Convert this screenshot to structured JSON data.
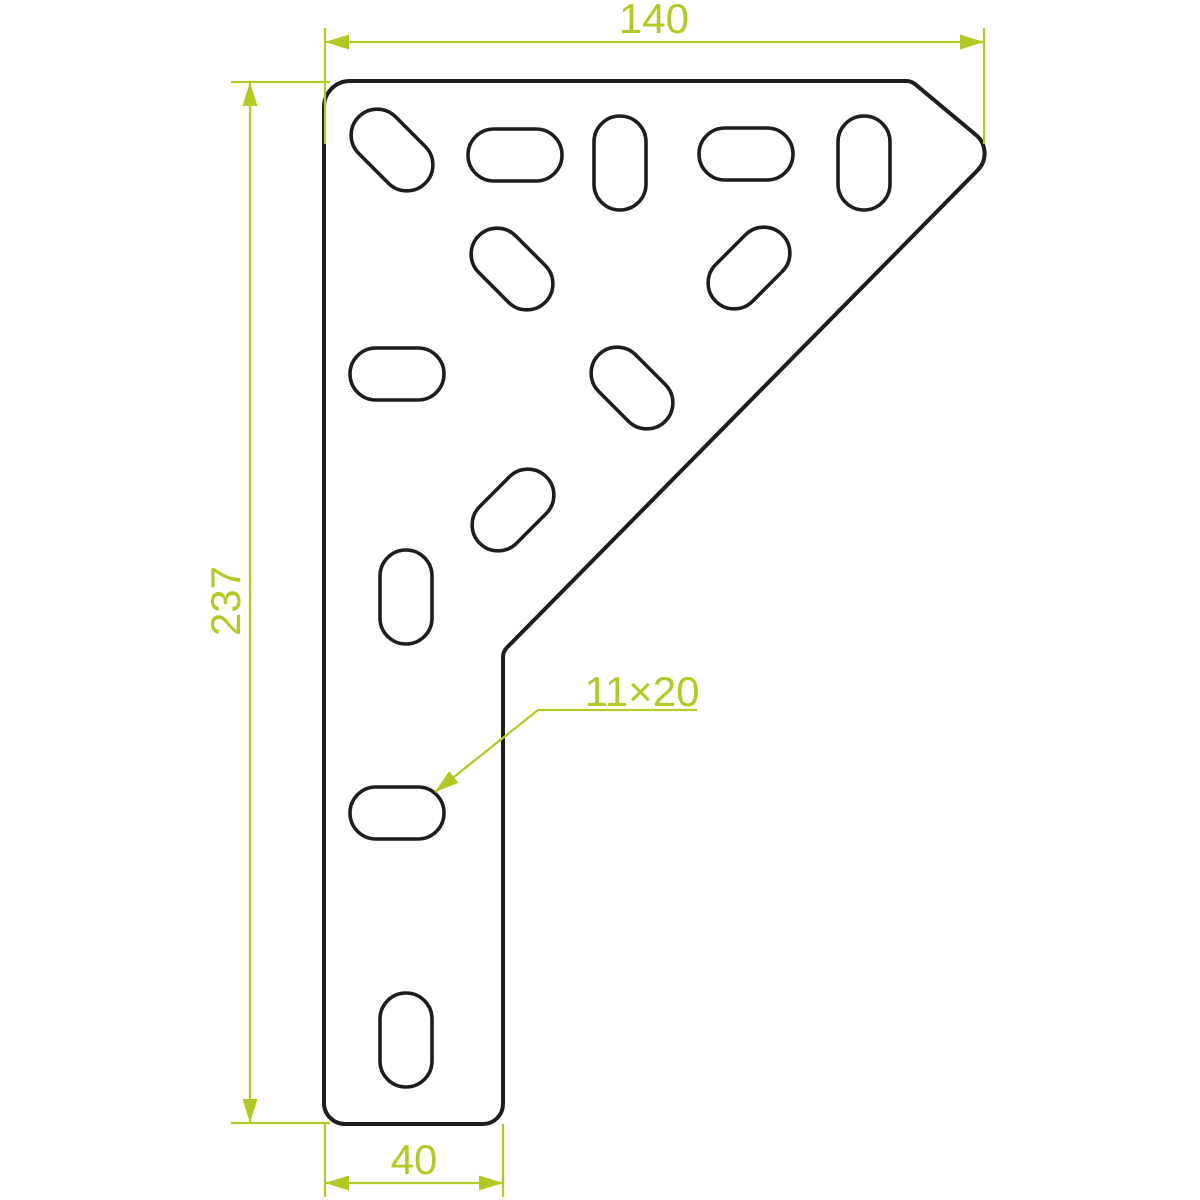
{
  "dimensions": {
    "top_width": "140",
    "left_height": "237",
    "bottom_width": "40",
    "slot_size": "11×20"
  },
  "colors": {
    "background": "#ffffff",
    "outline": "#1d1d1b",
    "dimension": "#b3c824"
  },
  "slots": [
    {
      "cx": 392,
      "cy": 150,
      "orientation": "diagonal-down"
    },
    {
      "cx": 515,
      "cy": 155,
      "orientation": "horizontal"
    },
    {
      "cx": 620,
      "cy": 163,
      "orientation": "vertical"
    },
    {
      "cx": 746,
      "cy": 154,
      "orientation": "horizontal"
    },
    {
      "cx": 864,
      "cy": 163,
      "orientation": "vertical"
    },
    {
      "cx": 512,
      "cy": 269,
      "orientation": "diagonal-down"
    },
    {
      "cx": 749,
      "cy": 268,
      "orientation": "diagonal-up"
    },
    {
      "cx": 397,
      "cy": 374,
      "orientation": "horizontal"
    },
    {
      "cx": 632,
      "cy": 388,
      "orientation": "diagonal-down"
    },
    {
      "cx": 513,
      "cy": 510,
      "orientation": "diagonal-up"
    },
    {
      "cx": 406,
      "cy": 597,
      "orientation": "vertical"
    },
    {
      "cx": 397,
      "cy": 813,
      "orientation": "horizontal"
    },
    {
      "cx": 406,
      "cy": 1040,
      "orientation": "vertical"
    }
  ]
}
